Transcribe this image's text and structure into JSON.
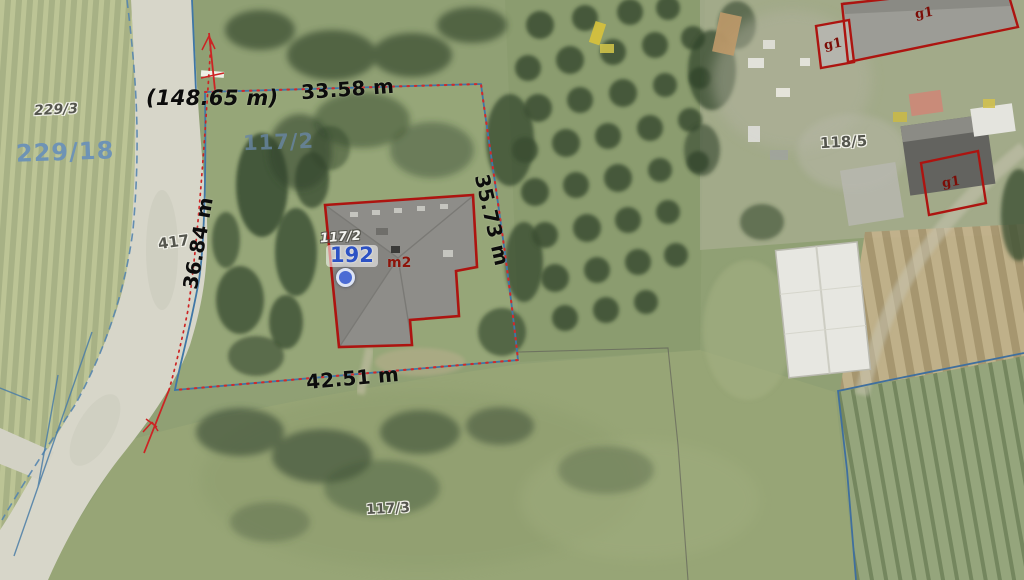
{
  "map": {
    "type": "cadastral-aerial-view",
    "parcels": {
      "p229_3": "229/3",
      "p229_18": "229/18",
      "p117_2_area": "117/2",
      "p117_2_building": "117/2",
      "p117_3": "117/3",
      "p118_5": "118/5",
      "p417_road": "417"
    },
    "measurements": {
      "road_total": "(148.65 m)",
      "north_side": "33.58 m",
      "west_side": "36.84 m",
      "east_side": "35.73 m",
      "south_side": "42.51 m"
    },
    "building": {
      "point_number": "192",
      "use_code": "m2"
    },
    "outbuildings": {
      "g1_small_west": "g1",
      "g1_long_north": "g1",
      "g1_east": "g1"
    },
    "colors": {
      "parcel_boundary_blue": "#3f77a6",
      "measurement_red": "#cc2424",
      "building_outline_red": "#ad1410",
      "parcel_label_blue": "#6e93b5",
      "point_marker_blue": "#4a6bd4"
    }
  }
}
